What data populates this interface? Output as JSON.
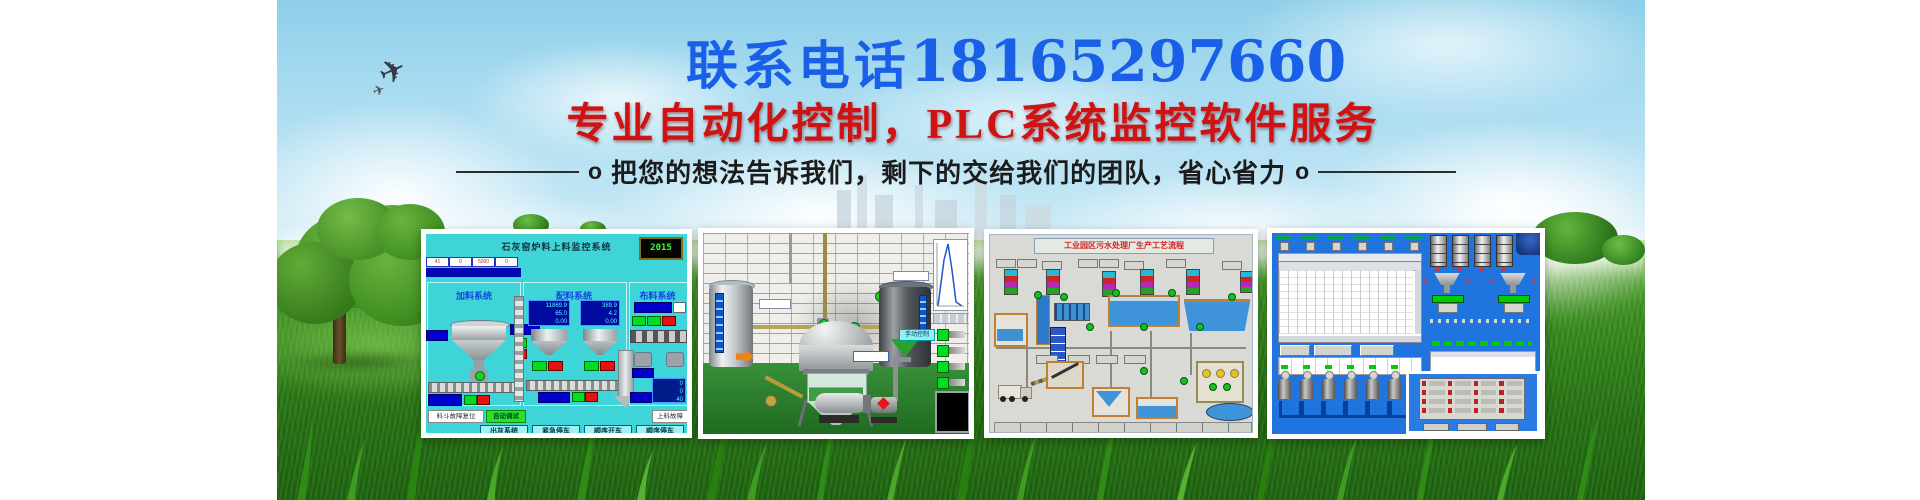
{
  "hero": {
    "phone_label": "联系电话",
    "phone_number": "18165297660",
    "headline": "专业自动化控制，PLC系统监控软件服务",
    "tagline": "把您的想法告诉我们，剩下的交给我们的团队，省心省力",
    "bullet": "o"
  },
  "colors": {
    "phone_blue": "#1a5fe8",
    "headline_red": "#cf1212",
    "sky_blue": "#9fd4ec",
    "grass_green": "#3f9222",
    "panel1_cyan": "#3ed4d8",
    "panel4_blue": "#1f74dd"
  },
  "icons": {
    "plane": "✈",
    "fail_x": "✕"
  },
  "panels": {
    "p1": {
      "title": "石灰窑炉料上料监控系统",
      "led": "2015",
      "strip": [
        "41",
        "0",
        "5000",
        "0"
      ],
      "sections": [
        "加料系统",
        "配料系统",
        "布料系统"
      ],
      "disp_a": [
        "11869.9",
        "65.0",
        "0.00"
      ],
      "disp_b": [
        "389.9",
        "4.2",
        "0.00"
      ],
      "disp_r": [
        "0",
        "0",
        "40"
      ],
      "reset_button": "料斗故障复位",
      "auto_button": "自动调试",
      "fault_label": "上料故障",
      "buttons": [
        "出灰系统",
        "紧急停车",
        "顺序开车",
        "顺序停车"
      ]
    },
    "p2": {
      "manual_label": "手动控制"
    },
    "p3": {
      "title": "工业园区污水处理厂生产工艺流程"
    },
    "p4": {}
  }
}
